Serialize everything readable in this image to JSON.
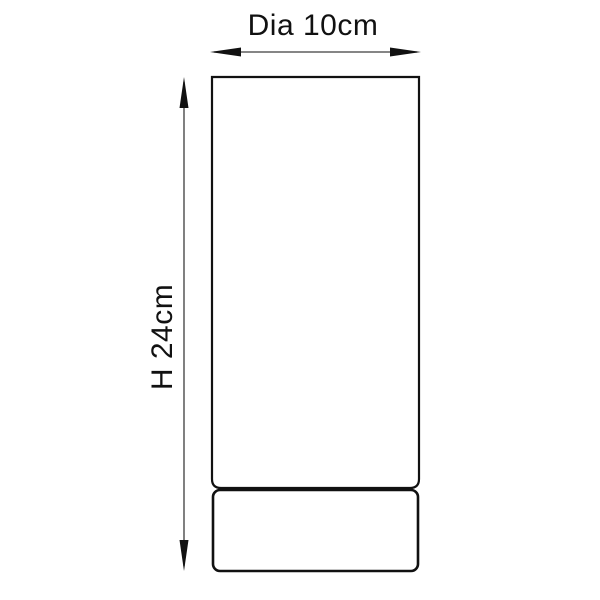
{
  "diagram": {
    "title": "product-dimension-diagram",
    "product_shape": "cylinder",
    "width_label": "Dia 10cm",
    "height_label": "H 24cm",
    "dimensions": {
      "diameter_cm": 10,
      "height_cm": 24
    },
    "colors": {
      "background": "#ffffff",
      "outline": "#111111",
      "dimension_line": "#3d3d3d",
      "text": "#111111"
    }
  }
}
